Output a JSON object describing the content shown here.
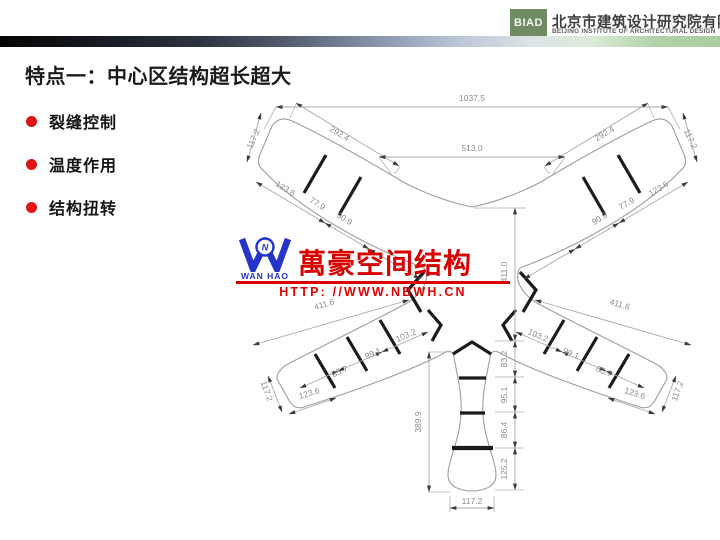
{
  "header": {
    "logo_text": "BIAD",
    "company_cn": "北京市建筑设计研究院有限公司",
    "company_en": "BEIJING INSTITUTE OF ARCHITECTURAL DESIGN",
    "logo_color": "#708c64"
  },
  "slide": {
    "title": "特点一：中心区结构超长超大",
    "bullet_color": "#e01212",
    "bullets": [
      {
        "label": "裂缝控制"
      },
      {
        "label": "温度作用"
      },
      {
        "label": "结构扭转"
      }
    ]
  },
  "watermark": {
    "logo_letter": "W",
    "logo_circle_letter": "N",
    "logo_sub": "WAN HAO",
    "brand": "萬豪空间结构",
    "url": "HTTP: //WWW.NBWH.CN",
    "red": "#d80000",
    "blue": "#2433c9"
  },
  "drawing": {
    "type": "dimensioned structural plan, Y-shaped three-wing footprint",
    "line_color": "#9f9f9f",
    "dims": {
      "overall_top": "1037.5",
      "top_center_span": "513.0",
      "wing_top_left_len": "292.4",
      "wing_top_right_len": "292.4",
      "wing_top_left_end": "117.2",
      "wing_top_right_end": "117.2",
      "wing_top_left_segs": [
        "123.6",
        "77.9",
        "90.9"
      ],
      "wing_top_right_segs": [
        "90.9",
        "77.9",
        "123.6"
      ],
      "center_height": "411.0",
      "wing_bottom_left_len": "411.6",
      "wing_bottom_right_len": "411.6",
      "wing_bottom_left_segs": [
        "103.2",
        "99.1",
        "85.7"
      ],
      "wing_bottom_right_segs": [
        "103.2",
        "99.1",
        "85.7"
      ],
      "wing_bottom_left_lower": "123.6",
      "wing_bottom_right_lower": "123.6",
      "wing_bottom_left_end": "117.2",
      "wing_bottom_right_end": "117.2",
      "stem_height": "389.9",
      "stem_segs": [
        "83.2",
        "95.1",
        "86.4",
        "125.2"
      ],
      "stem_width": "117.2"
    }
  }
}
